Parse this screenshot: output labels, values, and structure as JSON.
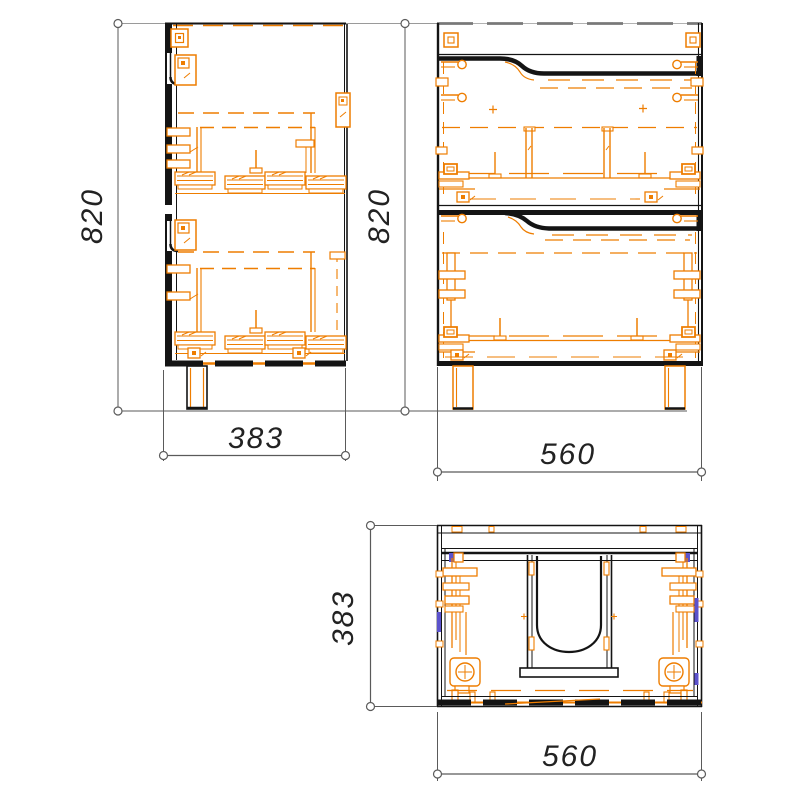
{
  "drawing": {
    "type": "cabinet-orthographic-views",
    "views": {
      "side": {
        "label": "side-view",
        "height_mm": "820",
        "depth_mm": "383"
      },
      "front": {
        "label": "front-view",
        "height_mm": "820",
        "width_mm": "560"
      },
      "top": {
        "label": "top-view",
        "depth_mm": "383",
        "width_mm": "560"
      }
    }
  },
  "colors": {
    "line": "#141414",
    "hw": "#ee7d00",
    "blue": "#5b52cc",
    "ext": "#9a9a9a",
    "dim": "#5a5a5a",
    "text": "#222222"
  }
}
